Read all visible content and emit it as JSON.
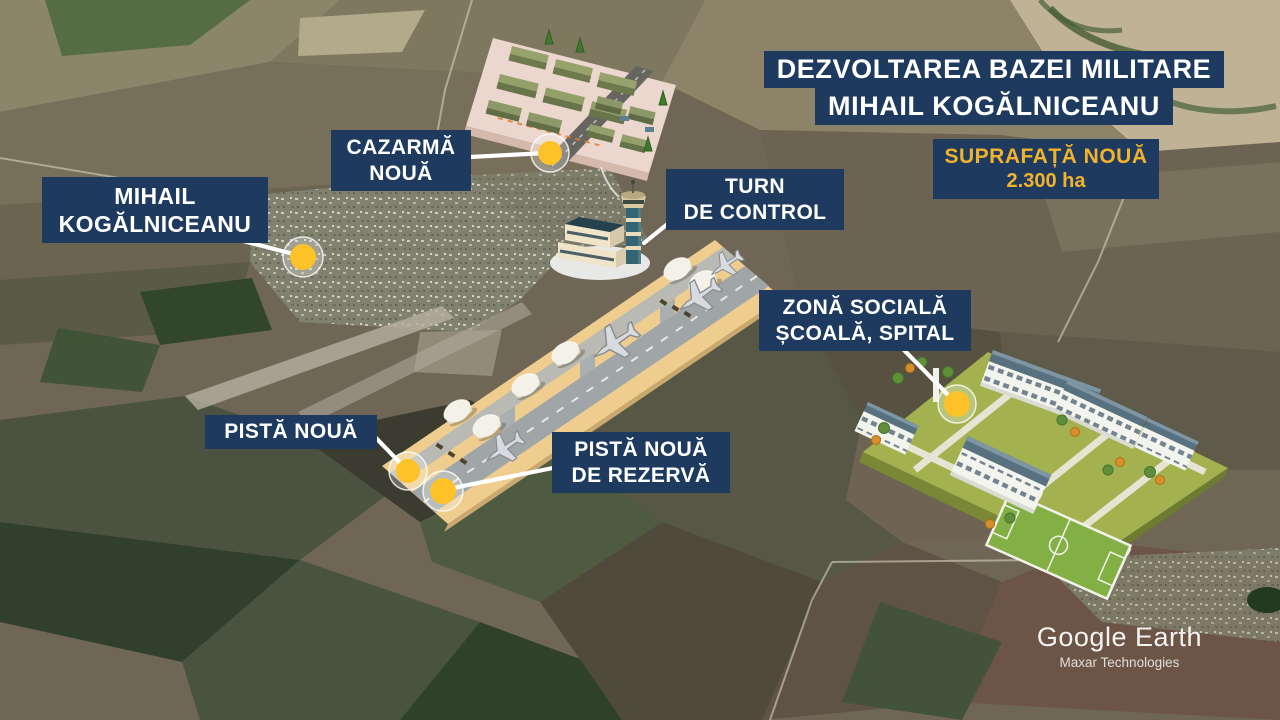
{
  "header": {
    "title_line1": "DEZVOLTAREA BAZEI MILITARE",
    "title_line2": "MIHAIL KOGĂLNICEANU",
    "surface_label": "SUPRAFAȚĂ NOUĂ",
    "surface_value": "2.300 ha"
  },
  "callouts": {
    "cazarma": {
      "line1": "CAZARMĂ",
      "line2": "NOUĂ"
    },
    "turn": {
      "line1": "TURN",
      "line2": "DE CONTROL"
    },
    "mihail": {
      "line1": "MIHAIL",
      "line2": "KOGĂLNICEANU"
    },
    "zona": {
      "line1": "ZONĂ SOCIALĂ",
      "line2": "ȘCOALĂ, SPITAL"
    },
    "pista": {
      "line1": "PISTĂ NOUĂ"
    },
    "rezerva": {
      "line1": "PISTĂ NOUĂ",
      "line2": "DE REZERVĂ"
    }
  },
  "credit": {
    "source": "Google Earth",
    "provider": "Maxar Technologies"
  },
  "colors": {
    "panel_navy": "#1e3a5f",
    "accent_yellow": "#f2b32c",
    "marker_yellow": "#fcc227"
  }
}
